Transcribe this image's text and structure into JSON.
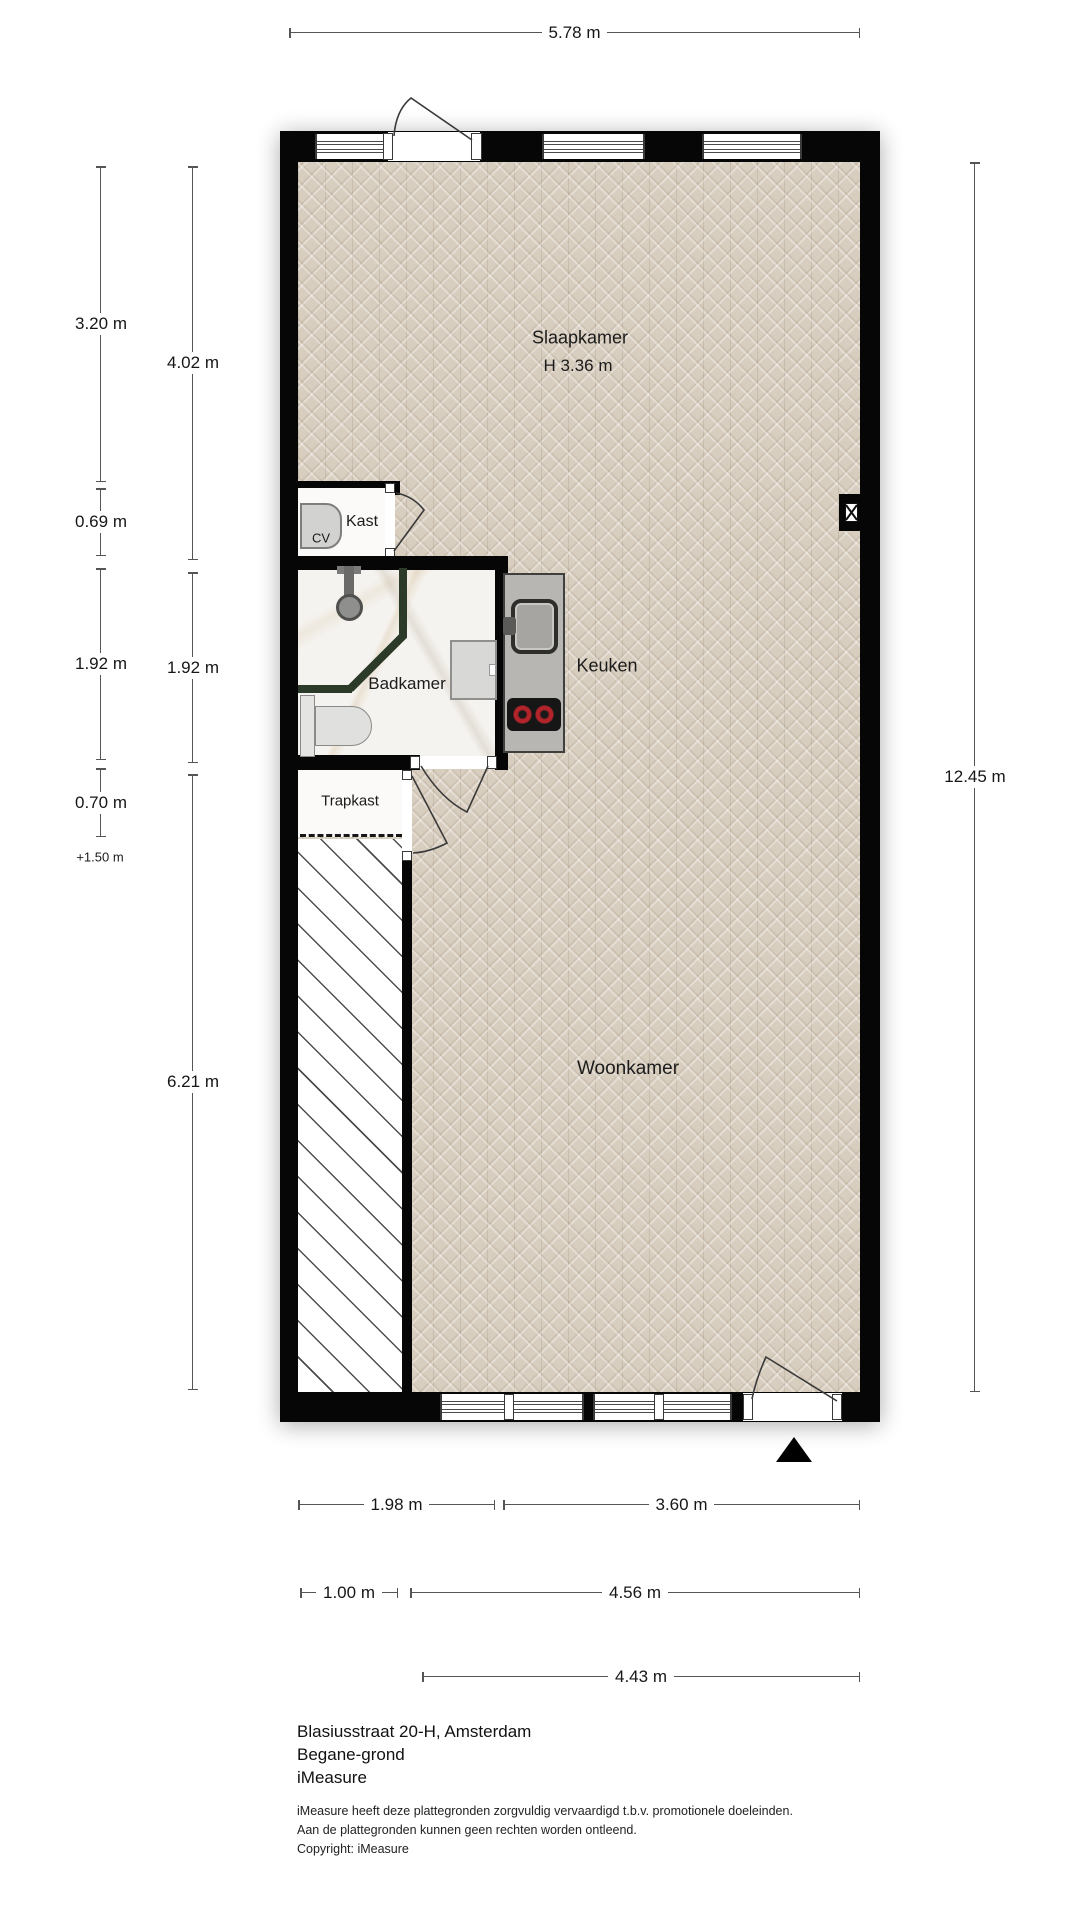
{
  "rooms": {
    "slaapkamer": {
      "label": "Slaapkamer",
      "ceiling": "H 3.36 m"
    },
    "kast": {
      "label": "Kast"
    },
    "cv": {
      "label": "CV"
    },
    "badkamer": {
      "label": "Badkamer"
    },
    "keuken": {
      "label": "Keuken"
    },
    "trapkast": {
      "label": "Trapkast"
    },
    "woonkamer": {
      "label": "Woonkamer"
    }
  },
  "dimensions": {
    "top": "5.78 m",
    "right": "12.45 m",
    "left_outer": [
      "3.20 m",
      "0.69 m",
      "1.92 m",
      "0.70 m"
    ],
    "left_level": "+1.50 m",
    "left_inner": [
      "4.02 m",
      "1.92 m",
      "6.21 m"
    ],
    "bottom_row1": [
      "1.98 m",
      "3.60 m"
    ],
    "bottom_row2": [
      "1.00 m",
      "4.56 m"
    ],
    "bottom_row3": [
      "4.43 m"
    ]
  },
  "footer": {
    "address": "Blasiusstraat 20-H, Amsterdam",
    "floor": "Begane-grond",
    "brand": "iMeasure",
    "disclaimer1": "iMeasure heeft deze plattegronden zorgvuldig vervaardigd t.b.v. promotionele doeleinden.",
    "disclaimer2": "Aan de plattegronden kunnen geen rechten worden ontleend.",
    "copyright": "Copyright: iMeasure"
  },
  "colors": {
    "wall": "#060606",
    "parquet": "#d8cec0",
    "partition_green": "#2c3a29",
    "burner_red": "#b3232a"
  }
}
